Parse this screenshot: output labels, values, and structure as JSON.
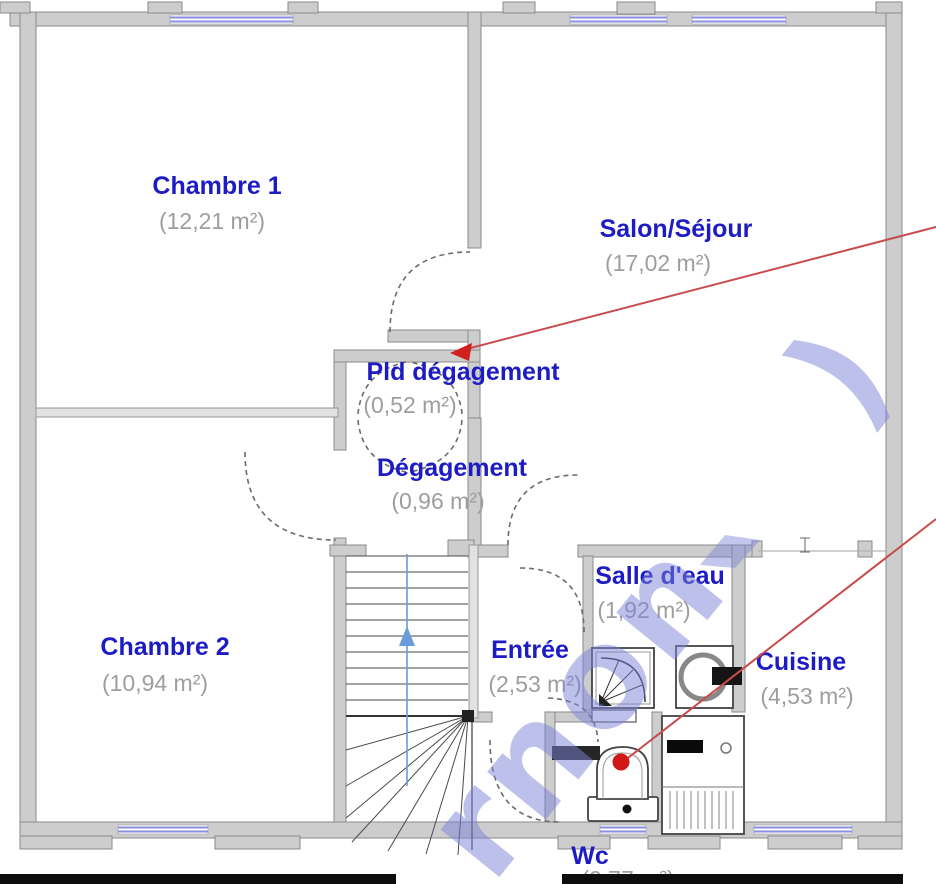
{
  "plan_type": "floor-plan",
  "rooms": [
    {
      "name": "Chambre 1",
      "area": "(12,21 m²)"
    },
    {
      "name": "Salon/Séjour",
      "area": "(17,02 m²)"
    },
    {
      "name": "Pld dégagement",
      "area": "(0,52 m²)"
    },
    {
      "name": "Dégagement",
      "area": "(0,96 m²)"
    },
    {
      "name": "Salle d'eau",
      "area": "(1,92 m²)"
    },
    {
      "name": "Entrée",
      "area": "(2,53 m²)"
    },
    {
      "name": "Cuisine",
      "area": "(4,53 m²)"
    },
    {
      "name": "Chambre 2",
      "area": "(10,94 m²)"
    },
    {
      "name": "Wc",
      "area": "(0,77 m²)"
    }
  ],
  "watermark": {
    "text": "rnon",
    "fragment": ")"
  },
  "colors": {
    "room_label": "#1d1cc4",
    "area_label": "#9e9e9e",
    "wall_fill": "#cdcdcd",
    "wall_edge": "#8a8a8a",
    "window_line": "#8b8fe0",
    "annotation_line": "#c84b4b",
    "annotation_marker": "#d21f1f",
    "watermark": "#7b82d8",
    "stairs_arrow": "#6b9bd8"
  }
}
